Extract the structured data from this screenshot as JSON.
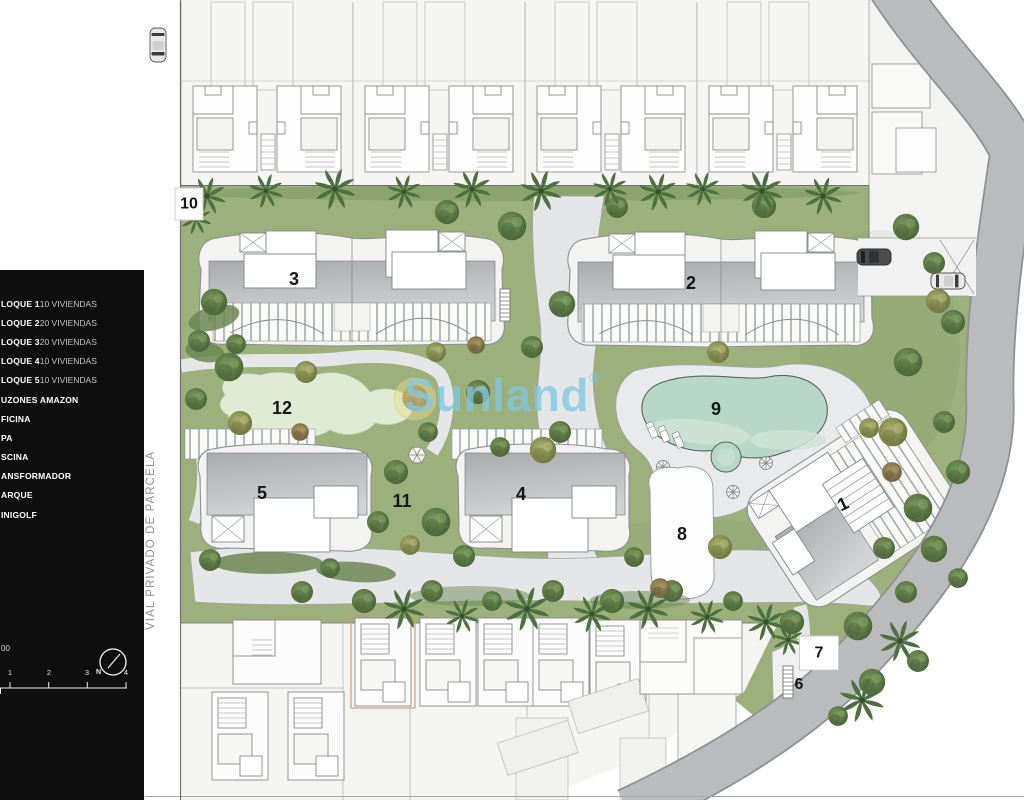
{
  "legend": {
    "items": [
      {
        "key": "LOQUE 1",
        "value": "10 VIVIENDAS"
      },
      {
        "key": "LOQUE 2",
        "value": "20 VIVIENDAS"
      },
      {
        "key": "LOQUE 3",
        "value": "20 VIVIENDAS"
      },
      {
        "key": "LOQUE 4",
        "value": "10 VIVIENDAS"
      },
      {
        "key": "LOQUE 5",
        "value": "10 VIVIENDAS"
      },
      {
        "key": "UZONES AMAZON",
        "value": ""
      },
      {
        "key": "FICINA",
        "value": ""
      },
      {
        "key": "PA",
        "value": ""
      },
      {
        "key": "SCINA",
        "value": ""
      },
      {
        "key": "ANSFORMADOR",
        "value": ""
      },
      {
        "key": "ARQUE",
        "value": ""
      },
      {
        "key": "INIGOLF",
        "value": ""
      }
    ],
    "scale_text": "00",
    "north_label": "N",
    "scale_ticks": [
      "1",
      "2",
      "3",
      "4"
    ]
  },
  "road_label": "VIAL PRIVADO DE PARCELA",
  "watermark": {
    "text": "Sunland",
    "registered": "®"
  },
  "markers": {
    "b1": "1",
    "b2": "2",
    "b3": "3",
    "b4": "4",
    "b5": "5",
    "b6": "6",
    "b7": "7",
    "b8": "8",
    "b9": "9",
    "b10": "10",
    "b11": "11",
    "b12": "12"
  },
  "colors": {
    "legend_bg": "#0e0e0e",
    "watermark_blue": "#80c7e0",
    "garden_green": "#9cb07c",
    "pool_water": "#b7d8c9",
    "road_gray": "#b9bbbd",
    "path_gray": "#e5e6e8"
  }
}
